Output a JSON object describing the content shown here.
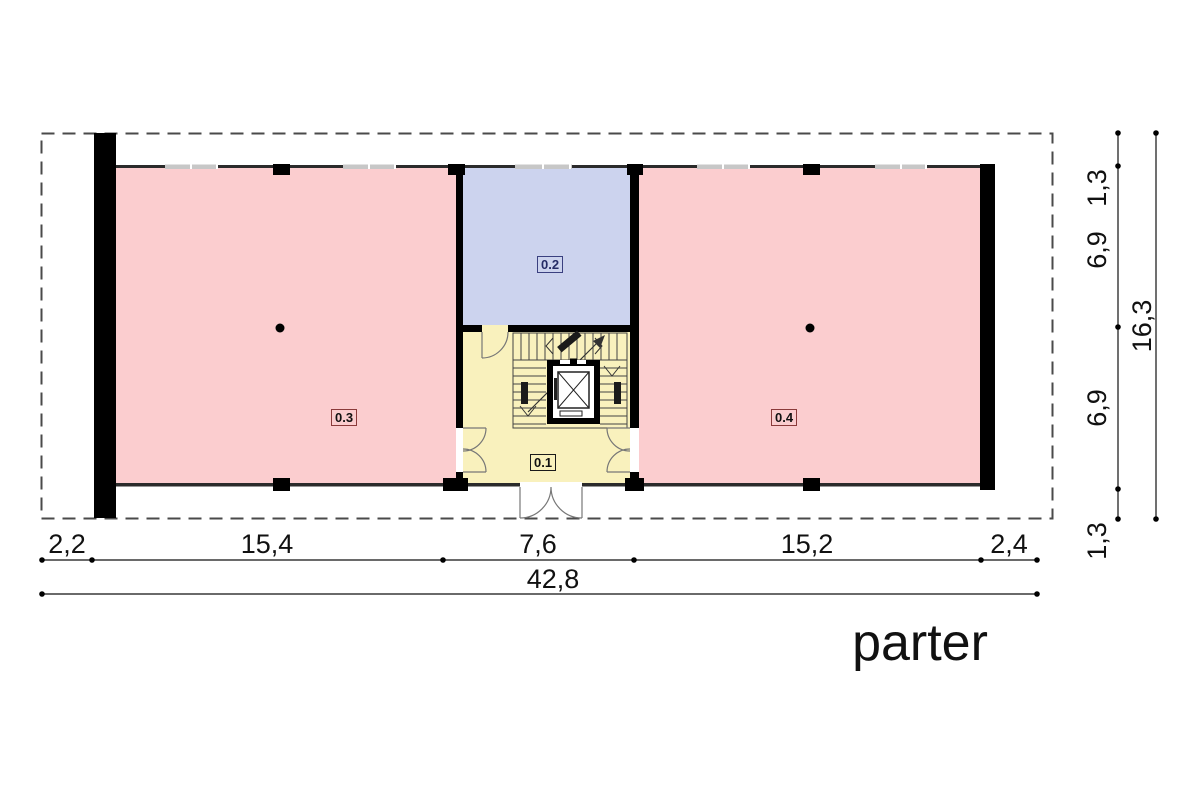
{
  "title": "parter",
  "rooms": [
    {
      "label": "0.1"
    },
    {
      "label": "0.2"
    },
    {
      "label": "0.3"
    },
    {
      "label": "0.4"
    }
  ],
  "dimensions": {
    "bottom": {
      "segments": [
        "2,2",
        "15,4",
        "7,6",
        "15,2",
        "2,4"
      ],
      "total": "42,8"
    },
    "right": {
      "segments": [
        "1,3",
        "6,9",
        "6,9",
        "1,3"
      ],
      "total": "16,3"
    }
  },
  "colors": {
    "room-pink": "#fbcdcf",
    "room-blue": "#ccd3ee",
    "room-yellow": "#f9f1bd",
    "wall": "#000000",
    "wall-thin": "#2b2b2b",
    "window": "#c7c7c7",
    "parcel-dash": "#4a4a4a",
    "dim-line": "#111111",
    "door-line": "#777777",
    "label-border-pink-rooms": "#8a3a3a",
    "label-border-blue-room": "#3a4080"
  }
}
